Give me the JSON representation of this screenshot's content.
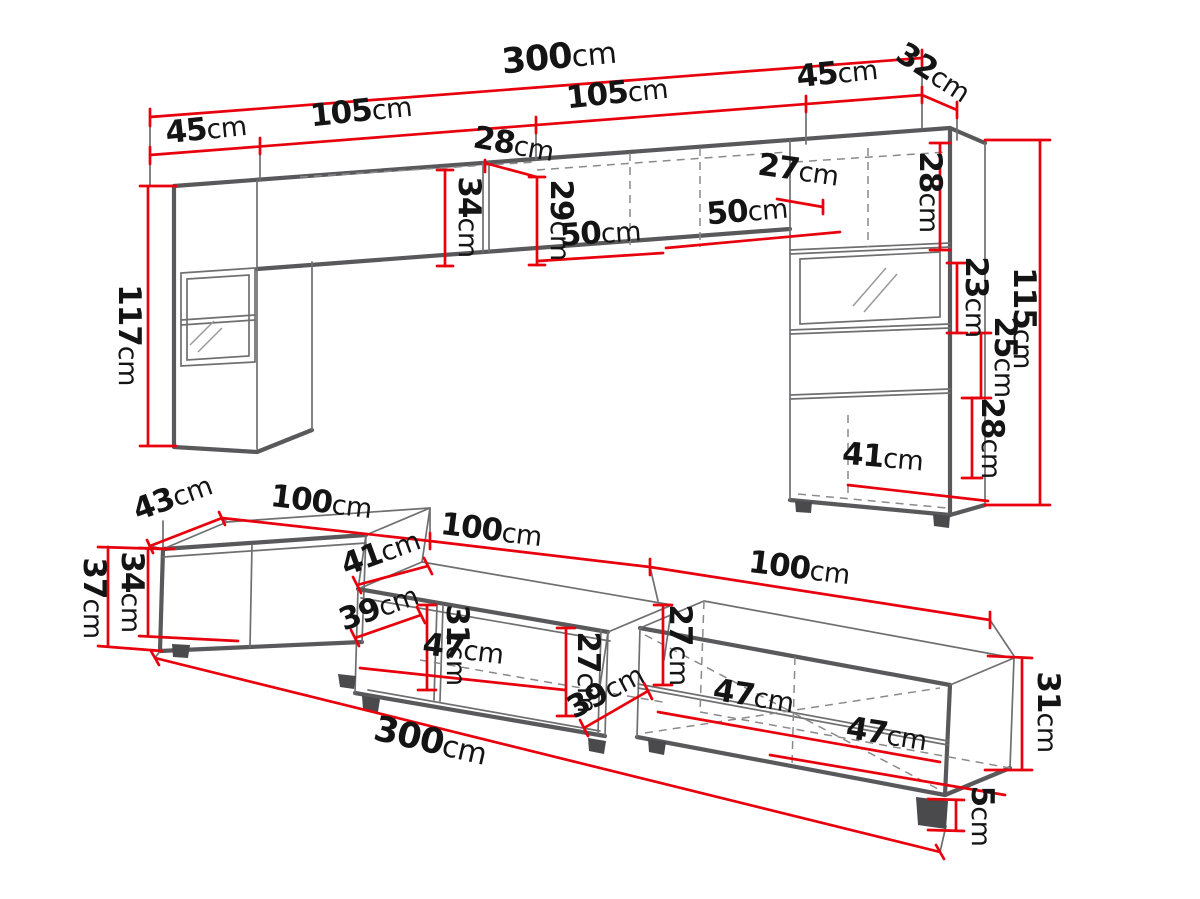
{
  "diagram_type": "furniture dimension drawing (wall unit and TV stand)",
  "unit": "cm",
  "colors": {
    "dimension_red": "#e8000d",
    "outline_gray": "#59595b",
    "label_black": "#141414",
    "background": "#ffffff"
  },
  "wall_unit": {
    "name": "upper wall unit",
    "dims": [
      {
        "id": "total-width",
        "value": "300",
        "unit": "cm"
      },
      {
        "id": "left-end-width",
        "value": "45",
        "unit": "cm"
      },
      {
        "id": "left-upper-cabinet-width",
        "value": "105",
        "unit": "cm"
      },
      {
        "id": "right-upper-cabinet-width",
        "value": "105",
        "unit": "cm"
      },
      {
        "id": "right-end-width",
        "value": "45",
        "unit": "cm"
      },
      {
        "id": "side-depth",
        "value": "32",
        "unit": "cm"
      },
      {
        "id": "center-cabinet-depth",
        "value": "28",
        "unit": "cm"
      },
      {
        "id": "center-cabinet-height-left",
        "value": "34",
        "unit": "cm"
      },
      {
        "id": "center-cabinet-height-right",
        "value": "29",
        "unit": "cm"
      },
      {
        "id": "shelf-span-left",
        "value": "50",
        "unit": "cm"
      },
      {
        "id": "shelf-span-right",
        "value": "50",
        "unit": "cm"
      },
      {
        "id": "upper-shelf-depth",
        "value": "27",
        "unit": "cm"
      },
      {
        "id": "left-column-height",
        "value": "117",
        "unit": "cm"
      },
      {
        "id": "right-cabinet-top-height",
        "value": "28",
        "unit": "cm"
      },
      {
        "id": "right-cabinet-glass-height",
        "value": "23",
        "unit": "cm"
      },
      {
        "id": "right-cabinet-shelf-height",
        "value": "25",
        "unit": "cm"
      },
      {
        "id": "right-cabinet-bottom-height",
        "value": "28",
        "unit": "cm"
      },
      {
        "id": "right-cabinet-height",
        "value": "115",
        "unit": "cm"
      },
      {
        "id": "right-cabinet-bottom-width",
        "value": "41",
        "unit": "cm"
      }
    ]
  },
  "tv_stand": {
    "name": "lower TV stand",
    "dims": [
      {
        "id": "side-depth",
        "value": "43",
        "unit": "cm"
      },
      {
        "id": "module-1-width",
        "value": "100",
        "unit": "cm"
      },
      {
        "id": "module-2-width",
        "value": "100",
        "unit": "cm"
      },
      {
        "id": "module-3-width",
        "value": "100",
        "unit": "cm"
      },
      {
        "id": "overall-height",
        "value": "37",
        "unit": "cm"
      },
      {
        "id": "door-height",
        "value": "34",
        "unit": "cm"
      },
      {
        "id": "step-depth",
        "value": "41",
        "unit": "cm"
      },
      {
        "id": "shelf-depth-left",
        "value": "39",
        "unit": "cm"
      },
      {
        "id": "opening-height-left",
        "value": "31",
        "unit": "cm"
      },
      {
        "id": "shelf-width-left",
        "value": "47",
        "unit": "cm"
      },
      {
        "id": "opening-height-middle",
        "value": "27",
        "unit": "cm"
      },
      {
        "id": "opening-height-right",
        "value": "27",
        "unit": "cm"
      },
      {
        "id": "shelf-depth-right",
        "value": "39",
        "unit": "cm"
      },
      {
        "id": "shelf-width-front",
        "value": "47",
        "unit": "cm"
      },
      {
        "id": "shelf-width-back",
        "value": "47",
        "unit": "cm"
      },
      {
        "id": "opening-height-end",
        "value": "31",
        "unit": "cm"
      },
      {
        "id": "total-width",
        "value": "300",
        "unit": "cm"
      },
      {
        "id": "foot-height",
        "value": "5",
        "unit": "cm"
      }
    ]
  }
}
